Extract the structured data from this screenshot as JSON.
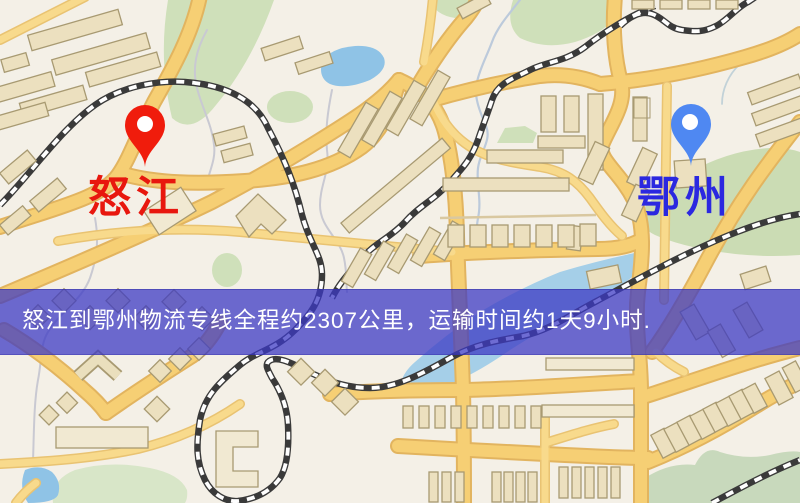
{
  "banner": {
    "text": "怒江到鄂州物流专线全程约2307公里，运输时间约1天9小时."
  },
  "markers": {
    "origin": {
      "label": "怒江",
      "pin_icon": "red-map-pin-icon"
    },
    "destination": {
      "label": "鄂州",
      "pin_icon": "blue-map-pin-icon"
    }
  },
  "route": {
    "distance_km": "2307",
    "duration": "1天9小时"
  },
  "colors": {
    "origin_color": "#e8170e",
    "origin_pin": "#f01c0c",
    "dest_color": "#2b28e0",
    "dest_pin": "#4f88f2",
    "banner_bg": "rgba(60,56,196,0.74)",
    "banner_text": "#ffffff",
    "road_fill": "#f6cf74",
    "road_casing": "#e2b45f",
    "water": "#a5cfe8",
    "park_green": "#cfe0ba",
    "building": "#ece0bf",
    "railway": "#3a3a3a",
    "map_bg": "#f4f0e7"
  }
}
